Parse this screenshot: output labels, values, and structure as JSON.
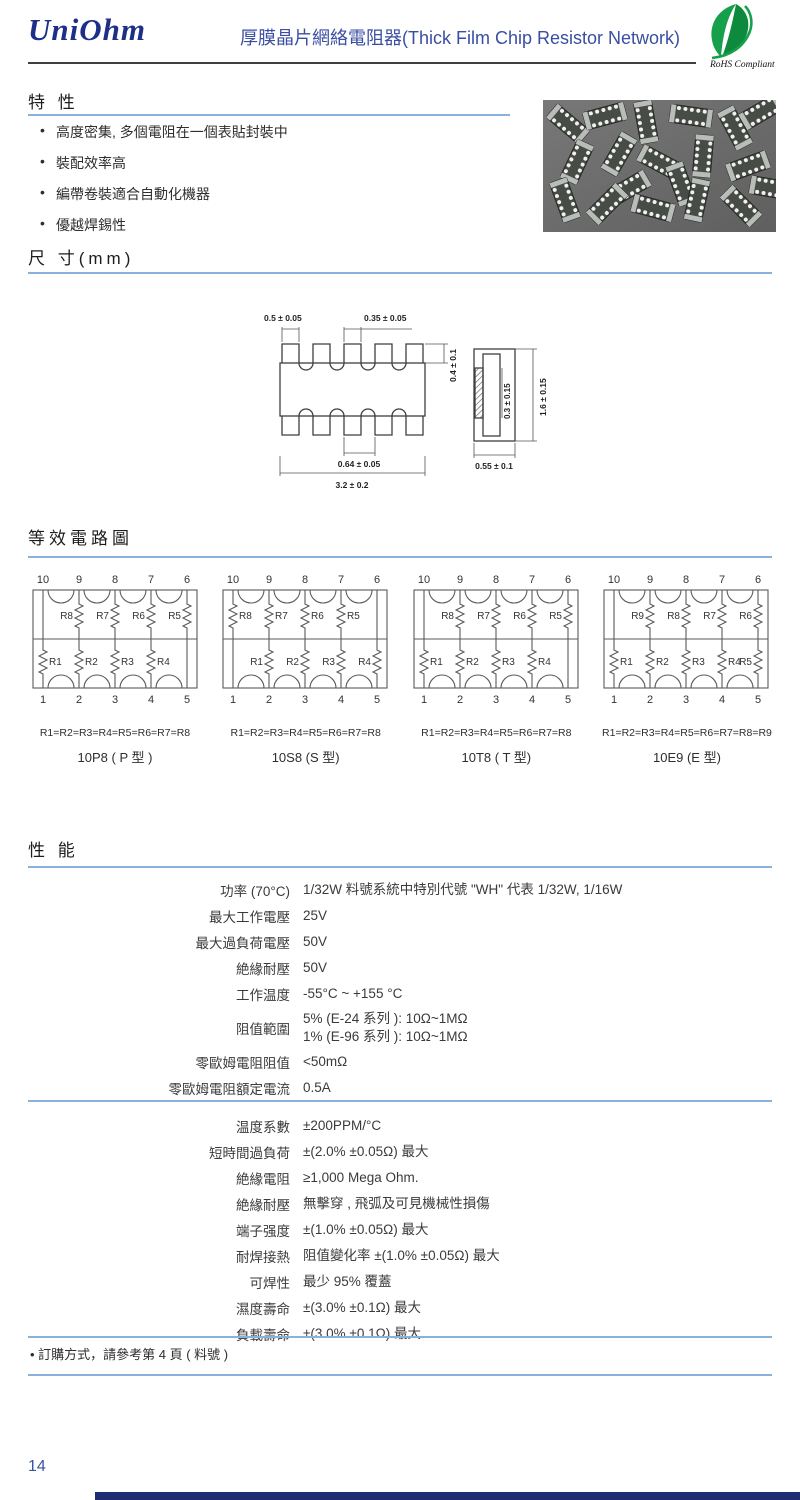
{
  "header": {
    "brand": "UniOhm",
    "title": "厚膜晶片網絡電阻器(Thick Film Chip Resistor Network)",
    "rohs_label": "RoHS Compliant"
  },
  "features": {
    "heading": "特 性",
    "items": [
      "高度密集, 多個電阻在一個表貼封裝中",
      "裝配效率高",
      "編帶卷裝適合自動化機器",
      "優越焊錫性"
    ]
  },
  "dimensions": {
    "heading": "尺 寸(mm)",
    "labels": {
      "pad_width": "0.5 ± 0.05",
      "pad_top": "0.35 ± 0.05",
      "pad_height": "0.4 ± 0.1",
      "pad_pitch": "0.64 ± 0.05",
      "body_length": "3.2 ± 0.2",
      "side_inner": "0.3 ± 0.15",
      "side_height": "1.6 ± 0.15",
      "side_width": "0.55 ± 0.1"
    }
  },
  "circuits": {
    "heading": "等效電路圖",
    "diagrams": [
      {
        "name": "10P8 ( P 型 )",
        "equation": "R1=R2=R3=R4=R5=R6=R7=R8",
        "top_pins": [
          "10",
          "9",
          "8",
          "7",
          "6"
        ],
        "bottom_pins": [
          "1",
          "2",
          "3",
          "4",
          "5"
        ],
        "top": [
          {
            "l": "R8",
            "p": 1,
            "s": "L"
          },
          {
            "l": "R7",
            "p": 2,
            "s": "L"
          },
          {
            "l": "R6",
            "p": 3,
            "s": "L"
          },
          {
            "l": "R5",
            "p": 4,
            "s": "L"
          }
        ],
        "bottom": [
          {
            "l": "R1",
            "p": 0,
            "s": "R"
          },
          {
            "l": "R2",
            "p": 1,
            "s": "R"
          },
          {
            "l": "R3",
            "p": 2,
            "s": "R"
          },
          {
            "l": "R4",
            "p": 3,
            "s": "R"
          }
        ],
        "plain_top": [
          0
        ],
        "plain_bottom": [
          4
        ]
      },
      {
        "name": "10S8 (S 型)",
        "equation": "R1=R2=R3=R4=R5=R6=R7=R8",
        "top_pins": [
          "10",
          "9",
          "8",
          "7",
          "6"
        ],
        "bottom_pins": [
          "1",
          "2",
          "3",
          "4",
          "5"
        ],
        "top": [
          {
            "l": "R8",
            "p": 0,
            "s": "R"
          },
          {
            "l": "R7",
            "p": 1,
            "s": "R"
          },
          {
            "l": "R6",
            "p": 2,
            "s": "R"
          },
          {
            "l": "R5",
            "p": 3,
            "s": "R"
          }
        ],
        "bottom": [
          {
            "l": "R1",
            "p": 1,
            "s": "L"
          },
          {
            "l": "R2",
            "p": 2,
            "s": "L"
          },
          {
            "l": "R3",
            "p": 3,
            "s": "L"
          },
          {
            "l": "R4",
            "p": 4,
            "s": "L"
          }
        ],
        "plain_top": [
          4
        ],
        "plain_bottom": [
          0
        ]
      },
      {
        "name": "10T8 ( T 型)",
        "equation": "R1=R2=R3=R4=R5=R6=R7=R8",
        "top_pins": [
          "10",
          "9",
          "8",
          "7",
          "6"
        ],
        "bottom_pins": [
          "1",
          "2",
          "3",
          "4",
          "5"
        ],
        "top": [
          {
            "l": "R8",
            "p": 1,
            "s": "L"
          },
          {
            "l": "R7",
            "p": 2,
            "s": "L"
          },
          {
            "l": "R6",
            "p": 3,
            "s": "L"
          },
          {
            "l": "R5",
            "p": 4,
            "s": "L"
          }
        ],
        "bottom": [
          {
            "l": "R1",
            "p": 0,
            "s": "R"
          },
          {
            "l": "R2",
            "p": 1,
            "s": "R"
          },
          {
            "l": "R3",
            "p": 2,
            "s": "R"
          },
          {
            "l": "R4",
            "p": 3,
            "s": "R"
          }
        ],
        "plain_top": [
          0
        ],
        "plain_bottom": [
          4
        ]
      },
      {
        "name": "10E9 (E 型)",
        "equation": "R1=R2=R3=R4=R5=R6=R7=R8=R9",
        "top_pins": [
          "10",
          "9",
          "8",
          "7",
          "6"
        ],
        "bottom_pins": [
          "1",
          "2",
          "3",
          "4",
          "5"
        ],
        "top": [
          {
            "l": "R9",
            "p": 1,
            "s": "L"
          },
          {
            "l": "R8",
            "p": 2,
            "s": "L"
          },
          {
            "l": "R7",
            "p": 3,
            "s": "L"
          },
          {
            "l": "R6",
            "p": 4,
            "s": "L"
          }
        ],
        "bottom": [
          {
            "l": "R1",
            "p": 0,
            "s": "R"
          },
          {
            "l": "R2",
            "p": 1,
            "s": "R"
          },
          {
            "l": "R3",
            "p": 2,
            "s": "R"
          },
          {
            "l": "R4",
            "p": 3,
            "s": "R"
          },
          {
            "l": "R5",
            "p": 4,
            "s": "L"
          }
        ],
        "plain_top": [
          0
        ],
        "plain_bottom": []
      }
    ]
  },
  "performance": {
    "heading": "性 能",
    "block1": [
      {
        "label": "功率 (70°C)",
        "values": [
          "1/32W 料號系統中特別代號 \"WH\" 代表 1/32W,  1/16W"
        ]
      },
      {
        "label": "最大工作電壓",
        "values": [
          "25V"
        ]
      },
      {
        "label": "最大過負荷電壓",
        "values": [
          "50V"
        ]
      },
      {
        "label": "絶緣耐壓",
        "values": [
          "50V"
        ]
      },
      {
        "label": "工作温度",
        "values": [
          "-55°C ~ +155 °C"
        ]
      },
      {
        "label": "阻值範圍",
        "values": [
          "5% (E-24 系列 ): 10Ω~1MΩ",
          "1% (E-96 系列 ): 10Ω~1MΩ"
        ]
      },
      {
        "label": "零歐姆電阻阻值",
        "values": [
          "<50mΩ"
        ]
      },
      {
        "label": "零歐姆電阻額定電流",
        "values": [
          "0.5A"
        ]
      }
    ],
    "block2": [
      {
        "label": "温度系數",
        "values": [
          "±200PPM/°C"
        ]
      },
      {
        "label": "短時間過負荷",
        "values": [
          "±(2.0% ±0.05Ω) 最大"
        ]
      },
      {
        "label": "絶緣電阻",
        "values": [
          "≥1,000 Mega Ohm."
        ]
      },
      {
        "label": "絶緣耐壓",
        "values": [
          "無擊穿 , 飛弧及可見機械性損傷"
        ]
      },
      {
        "label": "端子强度",
        "values": [
          "±(1.0% ±0.05Ω) 最大"
        ]
      },
      {
        "label": "耐焊接熱",
        "values": [
          "阻值變化率 ±(1.0% ±0.05Ω) 最大"
        ]
      },
      {
        "label": "可焊性",
        "values": [
          "最少 95% 覆蓋"
        ]
      },
      {
        "label": "濕度壽命",
        "values": [
          "±(3.0% ±0.1Ω) 最大"
        ]
      },
      {
        "label": "負載壽命",
        "values": [
          "±(3.0% ±0.1Ω) 最大"
        ]
      }
    ]
  },
  "order_note": "• 訂購方式，請參考第 4 頁 ( 料號 )",
  "page": {
    "number": "14"
  }
}
